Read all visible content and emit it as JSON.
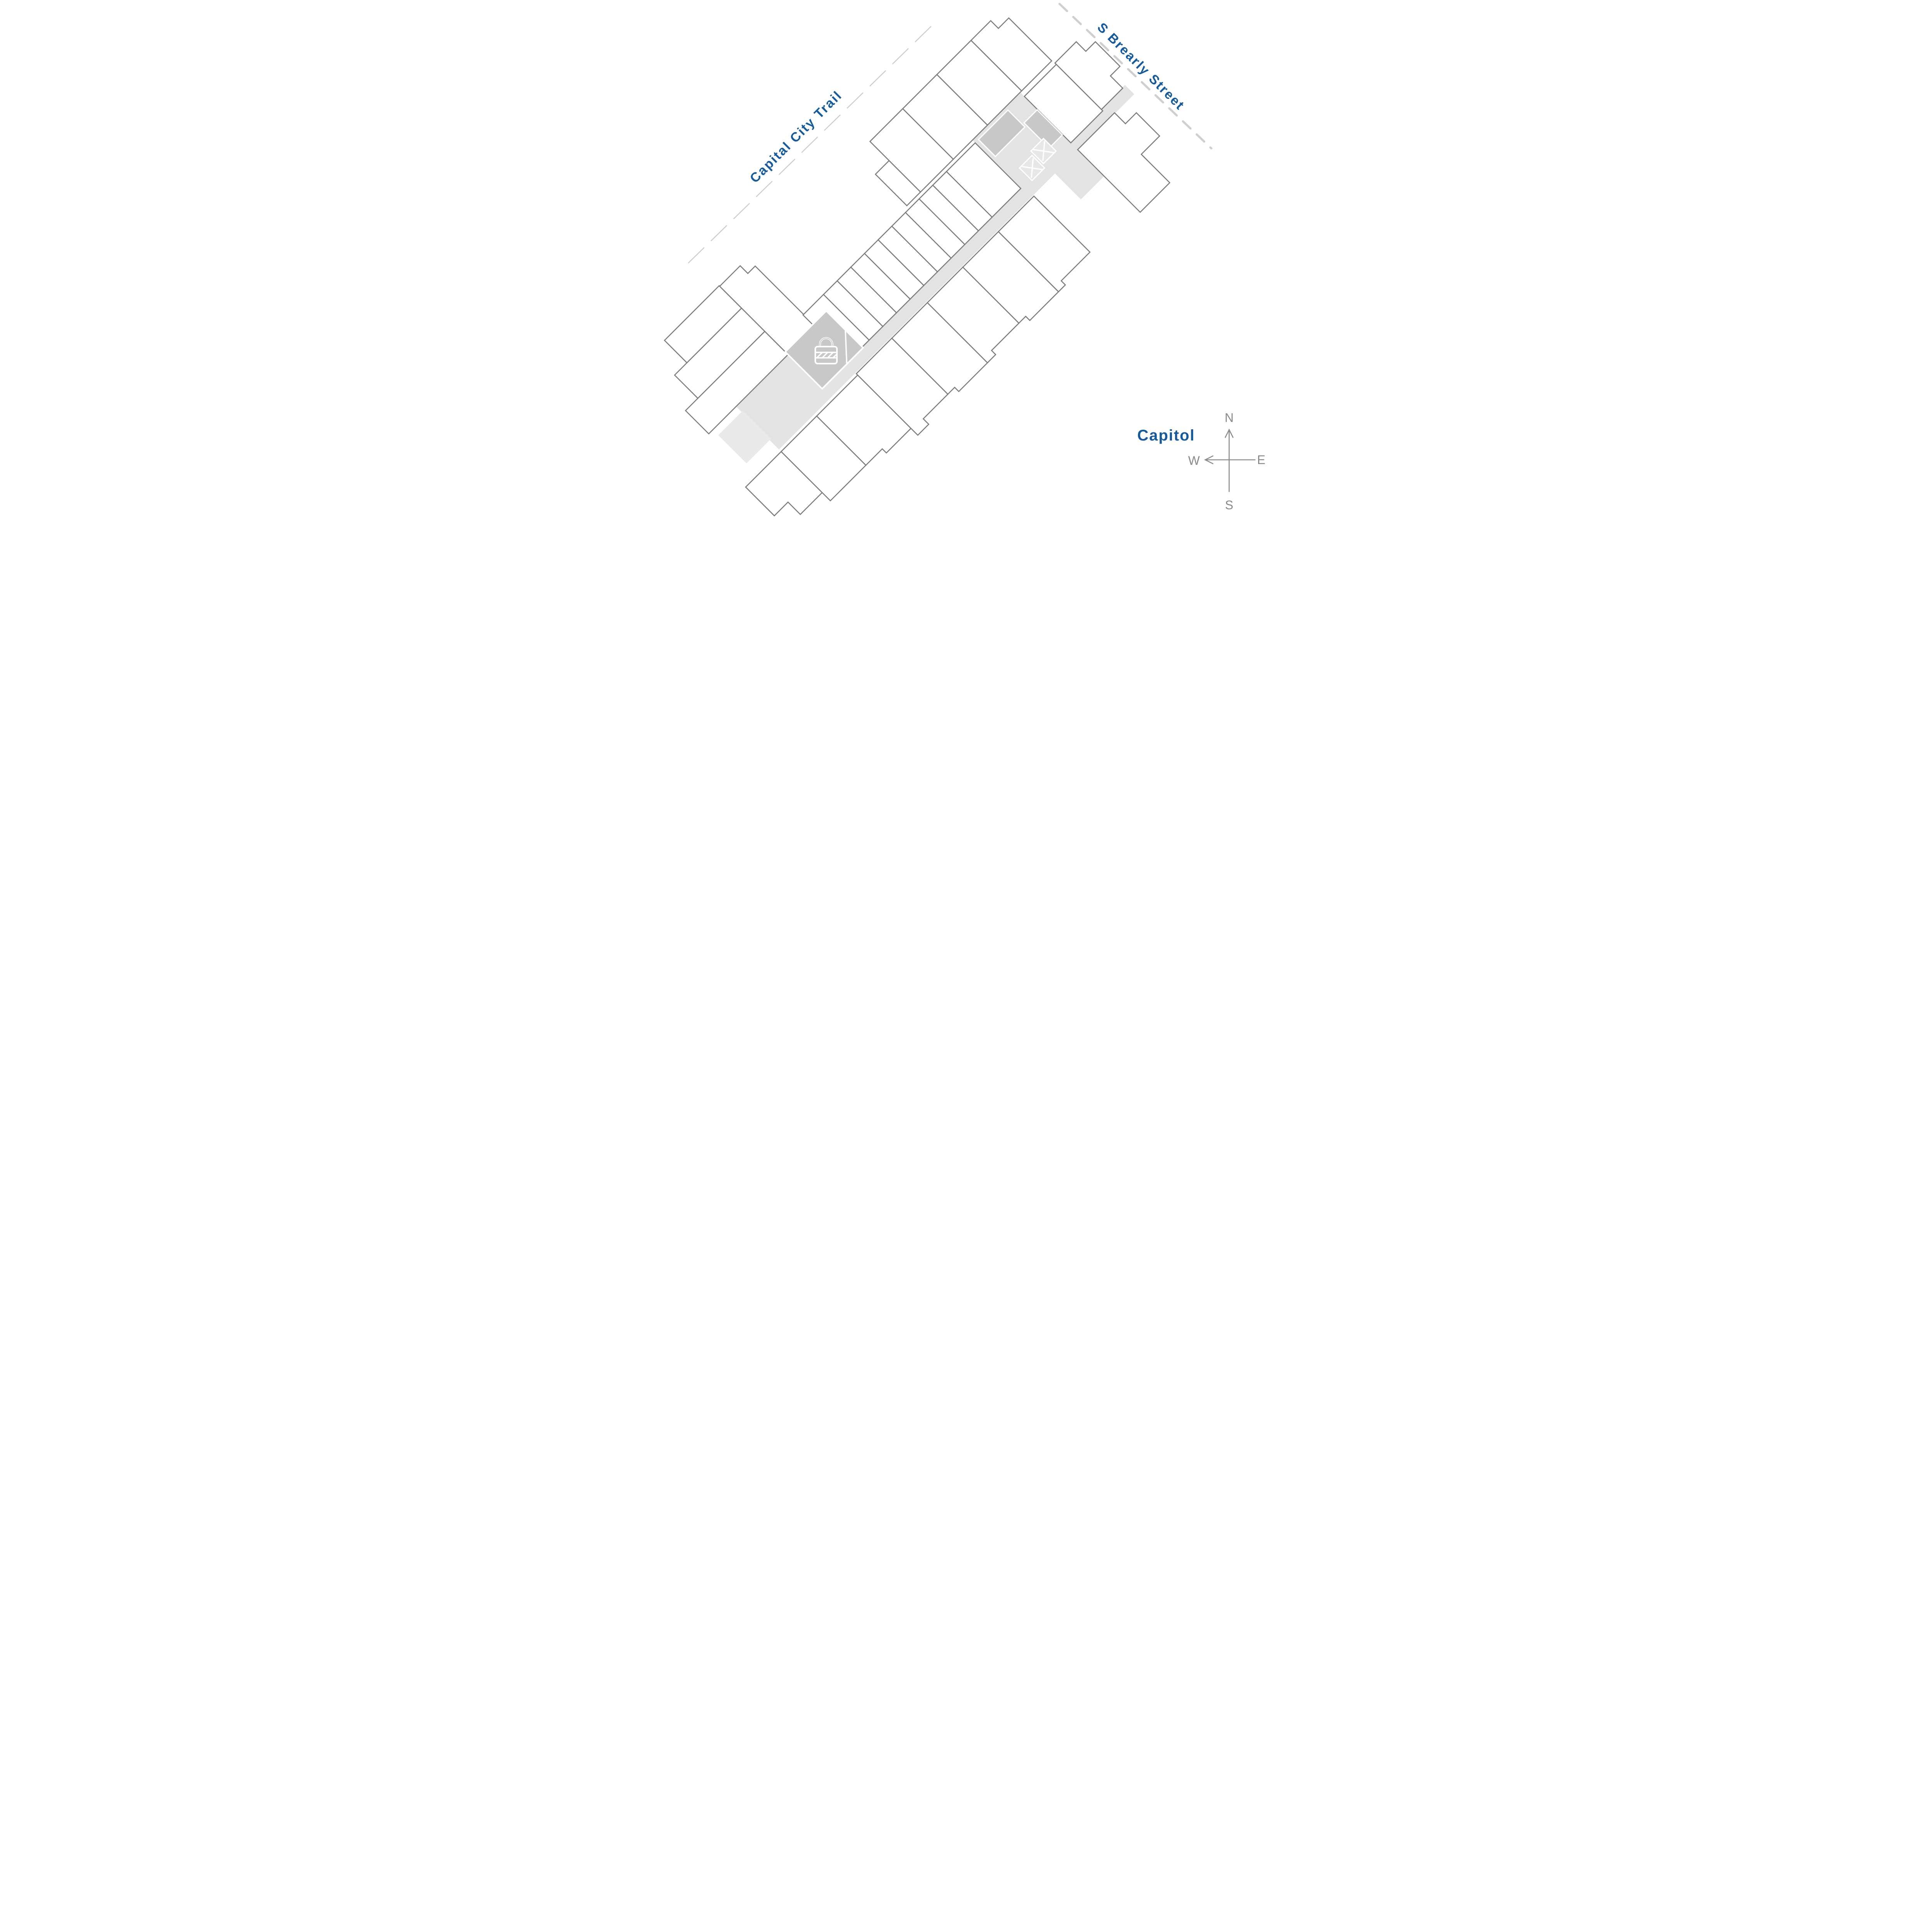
{
  "map": {
    "labels": {
      "trail": "Capital City Trail",
      "street": "S Brearly Street",
      "capitol": "Capitol"
    },
    "compass": {
      "north": "N",
      "east": "E",
      "south": "S",
      "west": "W"
    },
    "icons": {
      "lock": "lock-icon",
      "elevator": "elevator-x-icon",
      "north_arrow": "arrow-up-icon",
      "west_arrow": "arrow-left-icon"
    },
    "colors": {
      "highlight_blue": "#10589e",
      "label_blue": "#135a9e",
      "wall_gray": "#7b7b7b",
      "corridor_gray": "#e3e3e3",
      "amenity_gray": "#c8c8c8",
      "trail_dash_gray": "#cbcbcb",
      "street_dash_gray": "#cfcfcf",
      "compass_gray": "#8a8a8a"
    }
  }
}
